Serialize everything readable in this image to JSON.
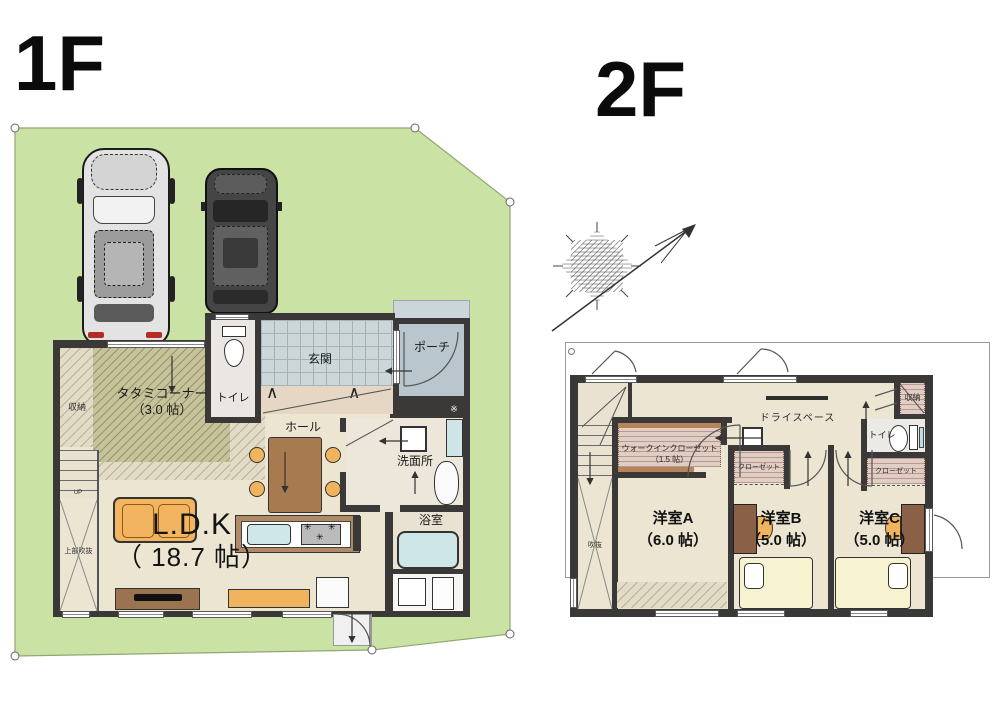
{
  "meta": {
    "plan_type": "floor-plan",
    "area_unit": "帖"
  },
  "colors": {
    "lot_green": "#cbe2a5",
    "wall_dark": "#3b3937",
    "floor_beige": "#ece5d2",
    "tatami_olive": "#c6c39a",
    "entrance_tile": "#cdd7da",
    "porch_gray": "#b9c6cd",
    "water_blue": "#cfe6e8",
    "furniture_orange": "#f0b45f",
    "wood_brown": "#a87a50",
    "closet_pink": "#e0cdc4",
    "bed_cream": "#f7f2cf"
  },
  "floor1": {
    "title": "1F",
    "rooms": {
      "ldk_name": "L.D.K",
      "ldk_size": "（ 18.7 帖）",
      "tatami_name": "タタミコーナー",
      "tatami_size": "（3.0 帖）",
      "storage": "収納",
      "toilet": "トイレ",
      "entrance": "玄関",
      "porch": "ポーチ",
      "hall": "ホール",
      "washroom": "洗面所",
      "bath": "浴室",
      "void_upper": "上部吹抜",
      "stairs_up": "UP",
      "vent_mark": "※"
    }
  },
  "floor2": {
    "title": "2F",
    "rooms": {
      "room_a_name": "洋室A",
      "room_a_size": "（6.0 帖）",
      "room_b_name": "洋室B",
      "room_b_size": "（5.0 帖）",
      "room_c_name": "洋室C",
      "room_c_size": "（5.0 帖）",
      "wic_name": "ウォークインクローゼット",
      "wic_size": "（1.5 帖）",
      "dry_space": "ドライスペース",
      "closet_b": "クローゼット",
      "closet_c": "クローゼット",
      "storage": "収納",
      "toilet": "トイレ",
      "void": "吹抜"
    }
  }
}
